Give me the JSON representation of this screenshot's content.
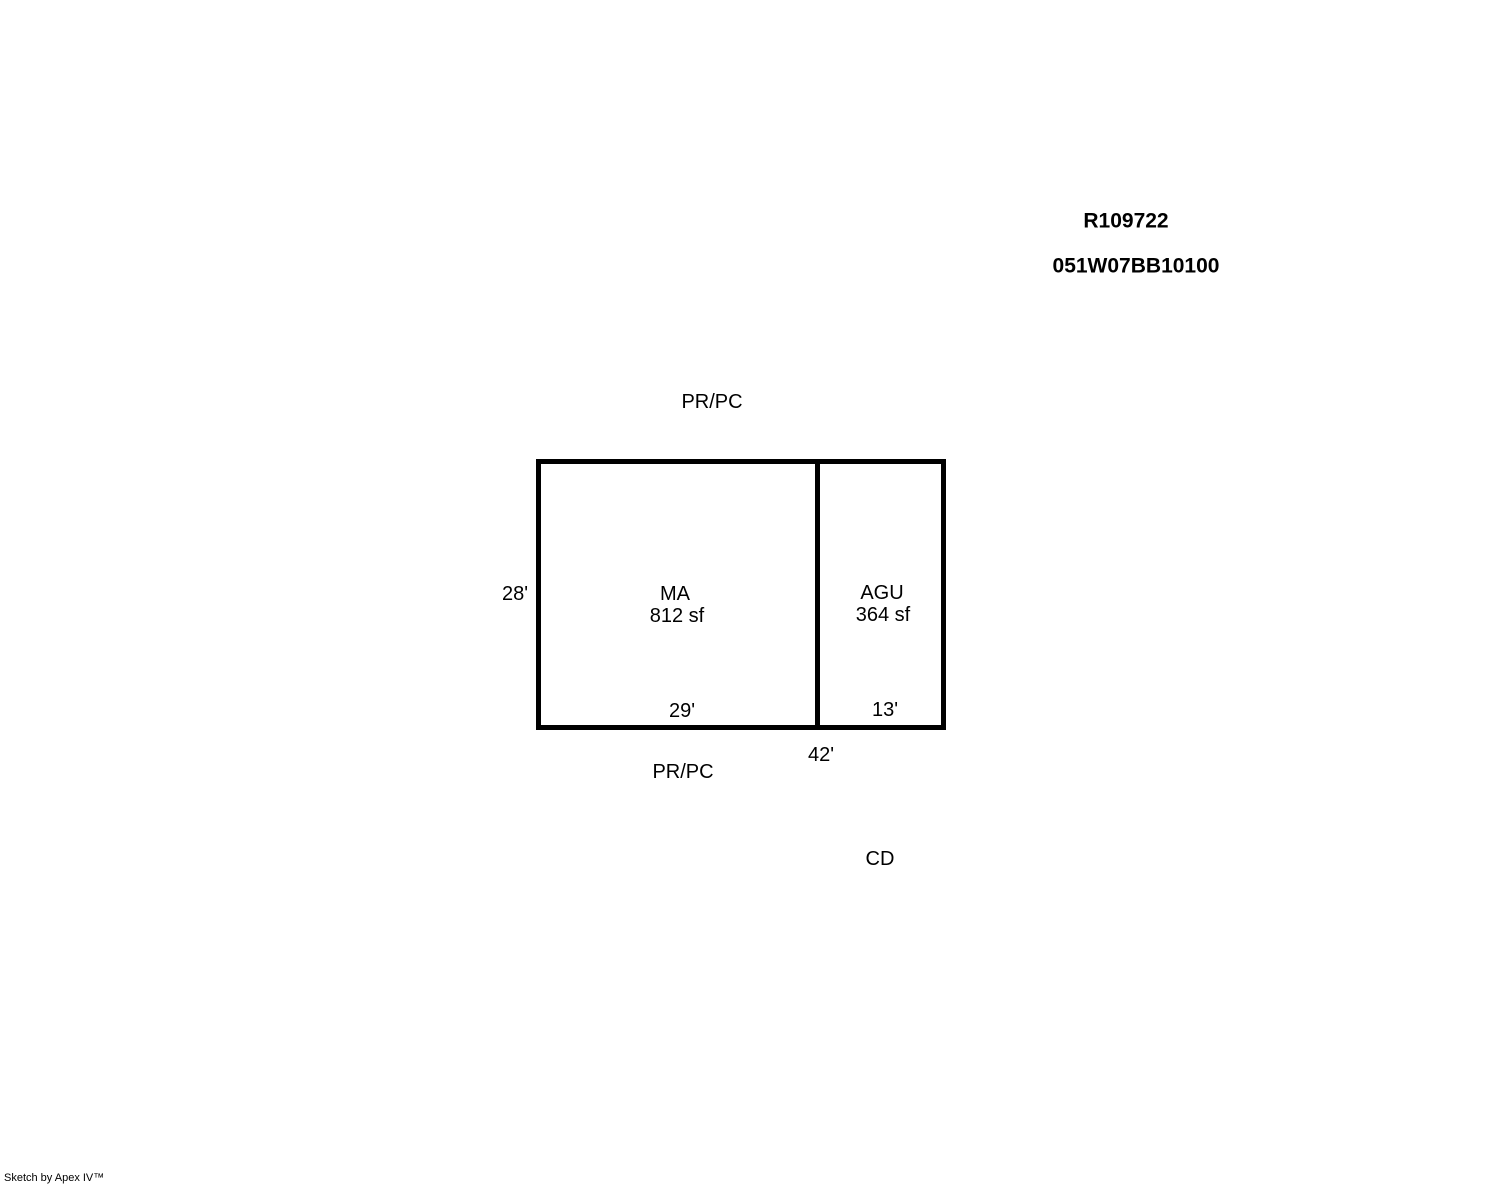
{
  "header": {
    "record_id": "R109722",
    "parcel_id": "051W07BB10100"
  },
  "sketch": {
    "boundary_labels": {
      "top": "PR/PC",
      "bottom": "PR/PC",
      "corner": "CD"
    },
    "sections": [
      {
        "code": "MA",
        "area": "812 sf",
        "width_dim": "29'"
      },
      {
        "code": "AGU",
        "area": "364 sf",
        "width_dim": "13'"
      }
    ],
    "dimensions": {
      "height": "28'",
      "total_width": "42'"
    }
  },
  "footer": {
    "credit": "Sketch by Apex IV™"
  }
}
